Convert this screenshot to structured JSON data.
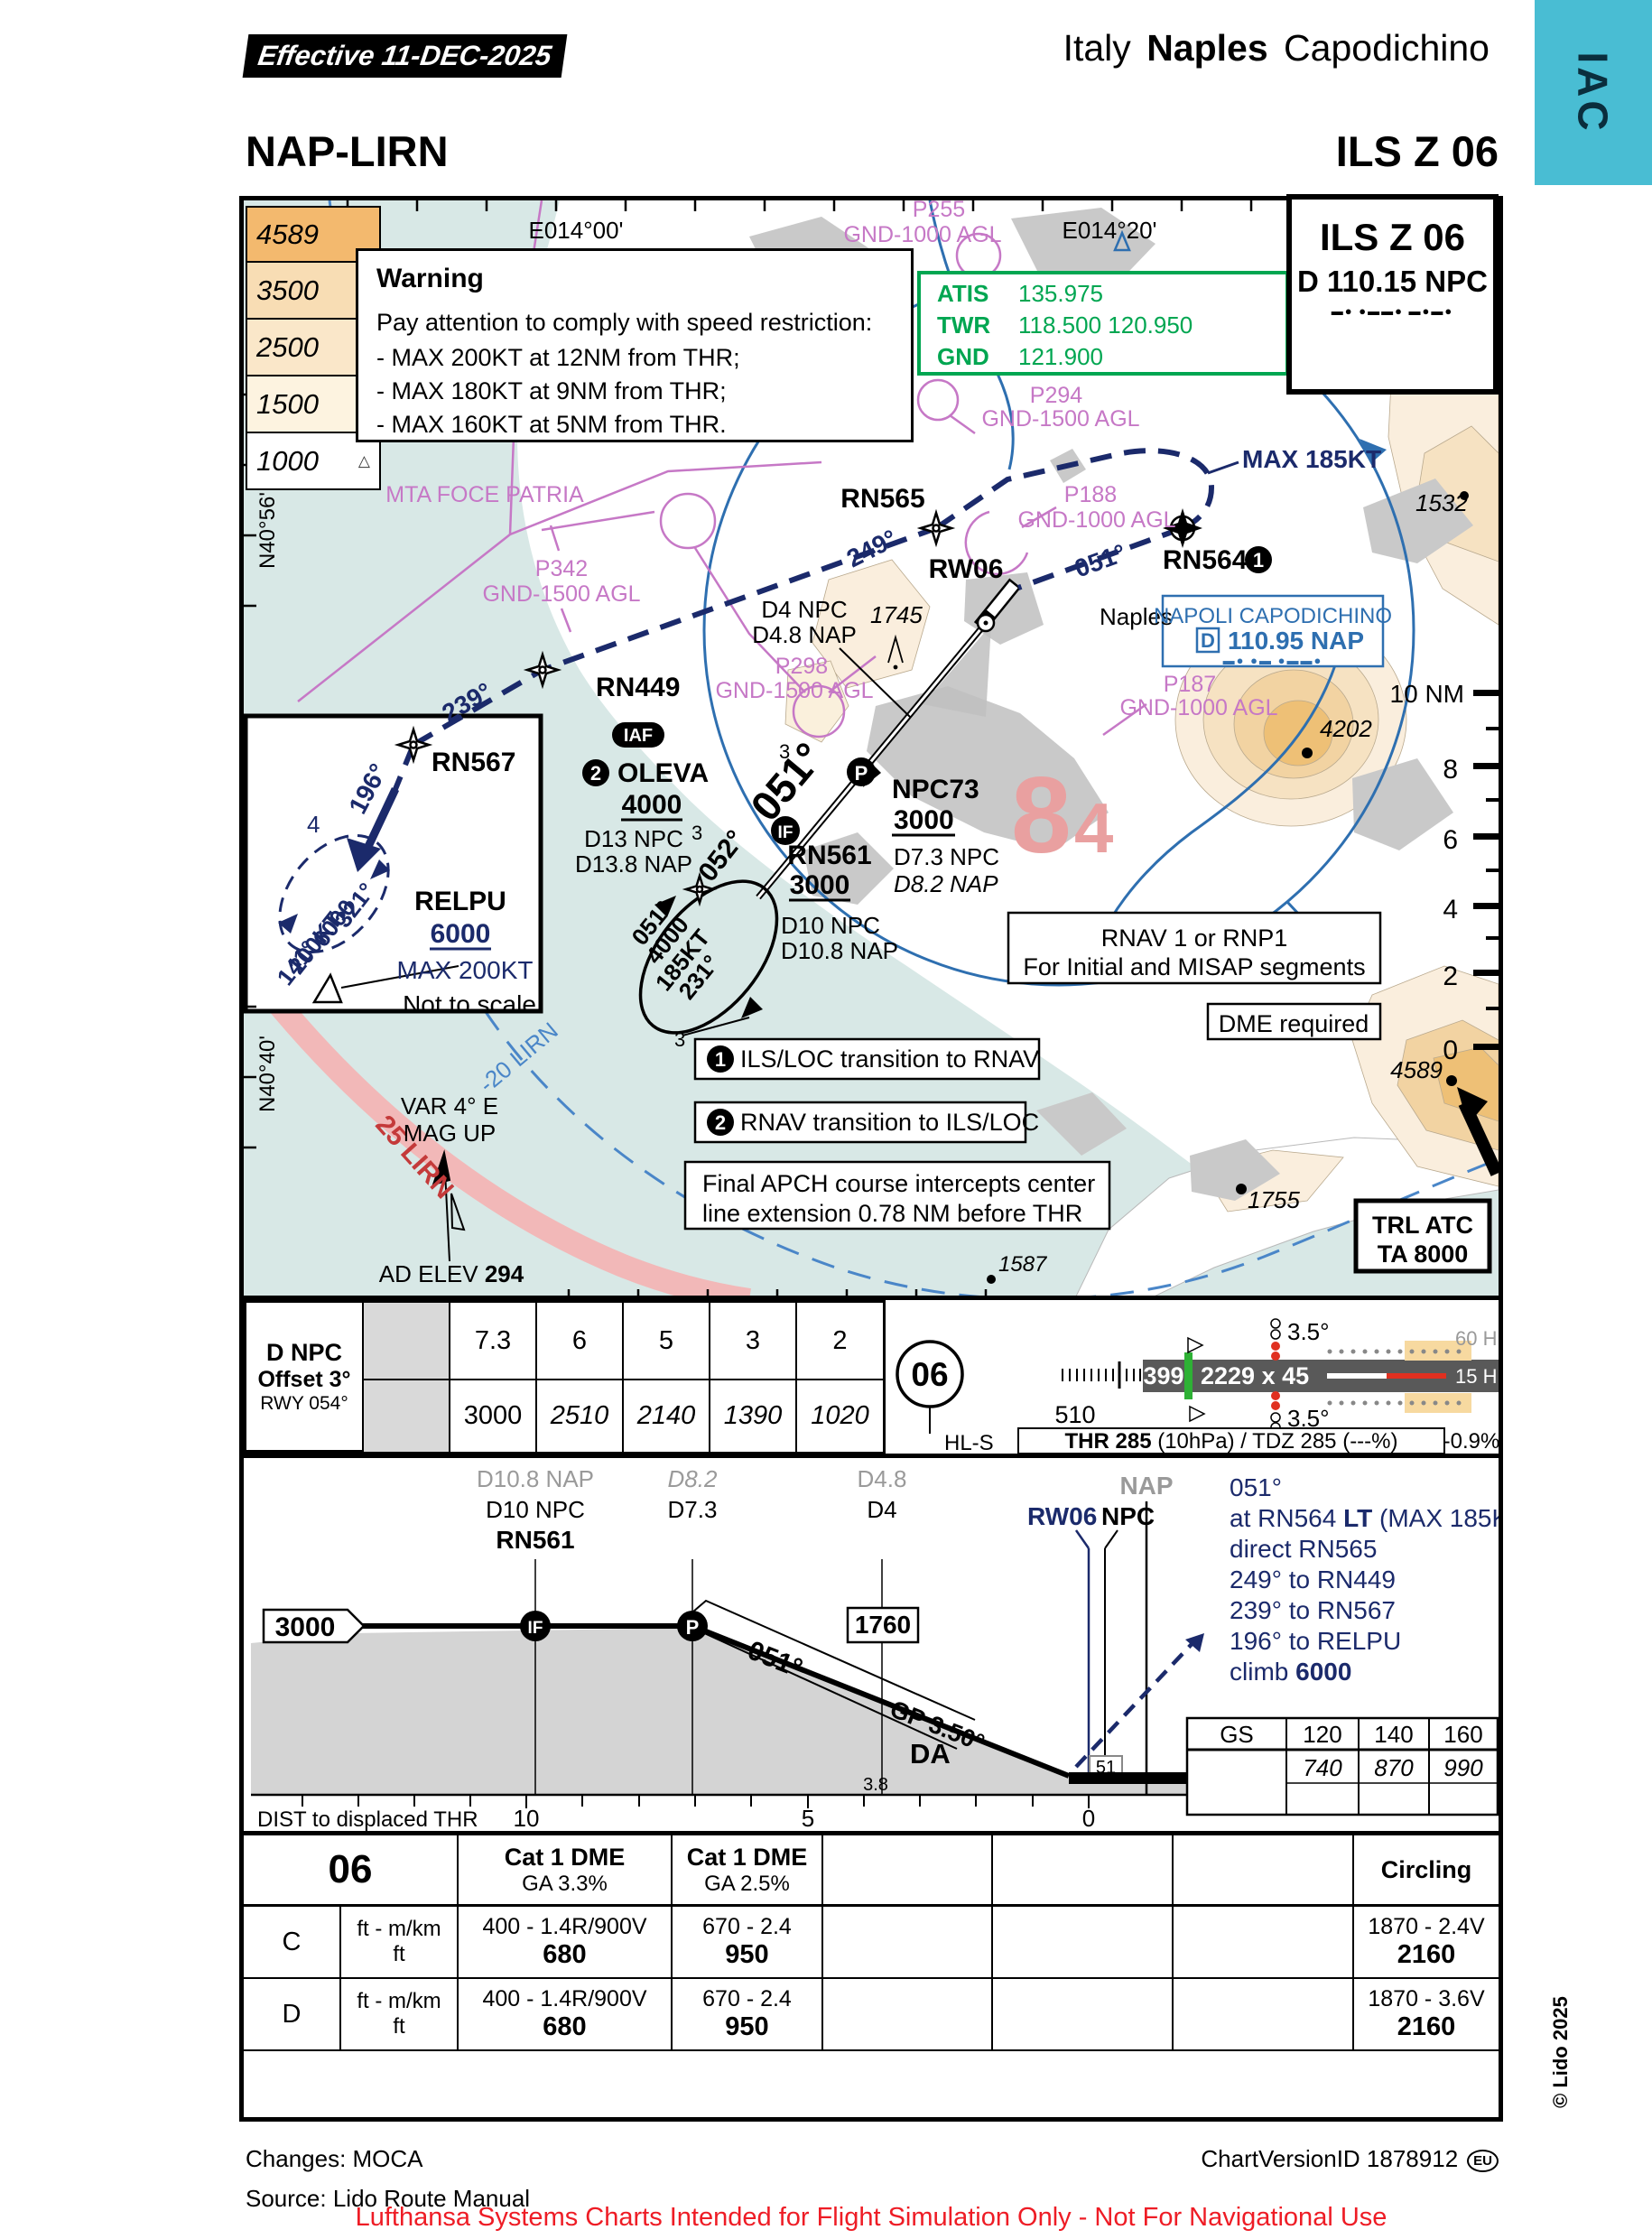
{
  "colors": {
    "accent_cyan": "#49bdd3",
    "green": "#00a651",
    "navy": "#1b2a6b",
    "blue": "#2e6fb0",
    "magenta": "#c678c6",
    "mora_pink": "#e9a0a0",
    "sea": "#d8e8e6",
    "terrain": "#f2d3a2",
    "warning_red": "#ee1c25"
  },
  "icons": {
    "mountain": "△"
  },
  "header": {
    "effective": "Effective  11-DEC-2025",
    "country": "Italy",
    "city": "Naples",
    "airport": "Capodichino",
    "tab": "IAC",
    "icao": "NAP-LIRN",
    "procedure": "ILS Z 06"
  },
  "ils_box": {
    "title": "ILS Z 06",
    "ident": "D 110.15 NPC",
    "morse": "▬●   ●▬▬●   ▬●▬●"
  },
  "warning": {
    "title": "Warning",
    "intro": "Pay attention to comply with speed restriction:",
    "l1": "- MAX 200KT  at 12NM from THR;",
    "l2": "- MAX 180KT at 9NM from THR;",
    "l3": "- MAX 160KT at 5NM from THR."
  },
  "atis": {
    "atis_label": "ATIS",
    "atis": "135.975",
    "twr_label": "TWR",
    "twr": "118.500  120.950",
    "gnd_label": "GND",
    "gnd": "121.900"
  },
  "alt_legend": [
    "4589",
    "3500",
    "2500",
    "1500",
    "1000"
  ],
  "map": {
    "lat_top": "N40°56'",
    "lat_bottom": "N40°40'",
    "lon_left": "E014°00'",
    "lon_right": "E014°20'",
    "p255": "P255",
    "p255_agl": "GND-1000 AGL",
    "p294": "P294",
    "p294_agl": "GND-1500 AGL",
    "p188": "P188",
    "p188_agl": "GND-1000 AGL",
    "p342": "P342",
    "p342_agl": "GND-1500 AGL",
    "p298": "P298",
    "p298_agl": "GND-1500 AGL",
    "p187": "P187",
    "p187_agl": "GND-1000 AGL",
    "mta": "MTA FOCE PATRIA",
    "max185": "MAX 185KT",
    "rn565": "RN565",
    "crs249": "249°",
    "rn564": "RN564",
    "n1": "1",
    "crs051_missed": "051°",
    "rw06": "RW06",
    "naples": "Naples",
    "napoli_name": "NAPOLI CAPODICHINO",
    "napoli_d": "D",
    "napoli_freq": "110.95 NAP",
    "napoli_morse": "▬●  ●▬  ●▬▬●",
    "d4npc": "D4 NPC",
    "d48nap": "D4.8 NAP",
    "crs239": "239°",
    "rn449": "RN449",
    "iaf": "IAF",
    "n2": "2",
    "oleva": "OLEVA",
    "oleva_alt": "4000",
    "d13npc": "D13 NPC",
    "d138nap": "D13.8 NAP",
    "crs052": "052°",
    "crs051_final": "051°",
    "p_badge": "P",
    "if_badge": "IF",
    "rn561": "RN561",
    "rn561_alt": "3000",
    "d10npc": "D10 NPC",
    "d108nap": "D10.8 NAP",
    "npc73": "NPC73",
    "npc73_alt": "3000",
    "d73npc": "D7.3 NPC",
    "d82nap": "D8.2 NAP",
    "mora_8": "8",
    "mora_4": "4",
    "hold_051": "051°",
    "hold_4000": "4000",
    "hold_185": "185KT",
    "hold_231": "231°",
    "g3a": "3",
    "g3b": "3",
    "g3c": "3",
    "rn567": "RN567",
    "crs196": "196°",
    "relpu": {
      "name": "RELPU",
      "alt": "6000",
      "max": "MAX 200KT",
      "note": "Not to scale",
      "n4": "4",
      "c321": "321°",
      "a6000": "6000",
      "s200": "200KT",
      "c141": "141°"
    },
    "rnav_note1": "RNAV 1 or RNP1",
    "rnav_note2": "For Initial and MISAP segments",
    "dme_note": "DME required",
    "note1": "ILS/LOC transition to RNAV",
    "note2": "RNAV transition to ILS/LOC",
    "note3a": "Final APCH course intercepts center",
    "note3b": "line extension 0.78 NM before THR",
    "lirn20": "-20 LIRN",
    "lirn25": "25 LIRN",
    "var1": "VAR 4° E",
    "var2": "MAG UP",
    "ad_elev_label": "AD ELEV ",
    "ad_elev": "294",
    "trl": "TRL ATC",
    "ta": "TA 8000",
    "nm10": "10 NM",
    "s8": "8",
    "s6": "6",
    "s4": "4",
    "s2": "2",
    "s0": "0",
    "e1532": "1532",
    "e4202": "4202",
    "e1745": "1745",
    "e4589": "4589",
    "e1755": "1755",
    "e1587": "1587"
  },
  "dnpc": {
    "l1": "D NPC",
    "l2": "Offset 3°",
    "l3": "RWY 054°",
    "d": [
      "7.3",
      "6",
      "5",
      "3",
      "2"
    ],
    "alt": [
      "3000",
      "2510",
      "2140",
      "1390",
      "1020"
    ]
  },
  "runway": {
    "id": "06",
    "hls": "HL-S",
    "n399": "399",
    "dim": "2229 x 45",
    "n510": "510",
    "papi_top": "3.5°",
    "papi_bottom": "3.5°",
    "hl60": "60 HL",
    "hl15": "15 HL",
    "thr_bold": "THR 285",
    "thr_rest": " (10hPa) / TDZ 285 (---%)",
    "slope": "-0.9%"
  },
  "profile": {
    "d108": "D10.8 NAP",
    "d10": "D10 NPC",
    "rn561": "RN561",
    "d82": "D8.2",
    "d73": "D7.3",
    "d48": "D4.8",
    "d4": "D4",
    "nap": "NAP",
    "rw06": "RW06",
    "npc": "NPC",
    "alt3000": "3000",
    "if": "IF",
    "p": "P",
    "crs": "051°",
    "alt1760": "1760",
    "gp": "GP 3.50°",
    "da": "DA",
    "thr51": "51",
    "ma1": "051°",
    "ma2a": "at RN564 ",
    "ma2b": "LT",
    "ma2c": " (MAX 185KT)",
    "ma3": "direct RN565",
    "ma4": "249° to RN449",
    "ma5": "239° to RN567",
    "ma6": "196° to RELPU",
    "ma7a": "climb ",
    "ma7b": "6000",
    "dist_label": "DIST to displaced THR",
    "t10": "10",
    "t5": "5",
    "t38": "3.8",
    "t0": "0"
  },
  "gs": {
    "h": [
      "GS",
      "120",
      "140",
      "160"
    ],
    "v": [
      "740",
      "870",
      "990"
    ]
  },
  "minimums": {
    "rwy": "06",
    "cat1": "Cat 1 DME",
    "ga1": "GA 3.3%",
    "cat2": "Cat 1 DME",
    "ga2": "GA 2.5%",
    "circling": "Circling",
    "rowC": {
      "cat": "C",
      "u1": "ft - m/km",
      "u2": "ft",
      "a1": "400 - 1.4R/900V",
      "a2": "680",
      "b1": "670 - 2.4",
      "b2": "950",
      "c1": "1870 - 2.4V",
      "c2": "2160"
    },
    "rowD": {
      "cat": "D",
      "u1": "ft - m/km",
      "u2": "ft",
      "a1": "400 - 1.4R/900V",
      "a2": "680",
      "b1": "670 - 2.4",
      "b2": "950",
      "c1": "1870 - 3.6V",
      "c2": "2160"
    }
  },
  "footer": {
    "changes": "Changes: MOCA",
    "source": "Source: Lido Route Manual",
    "version": "ChartVersionID 1878912",
    "eu": "EU",
    "copyright": "© Lido 2025",
    "disclaimer": "Lufthansa Systems Charts Intended for Flight Simulation Only - Not For Navigational Use"
  }
}
